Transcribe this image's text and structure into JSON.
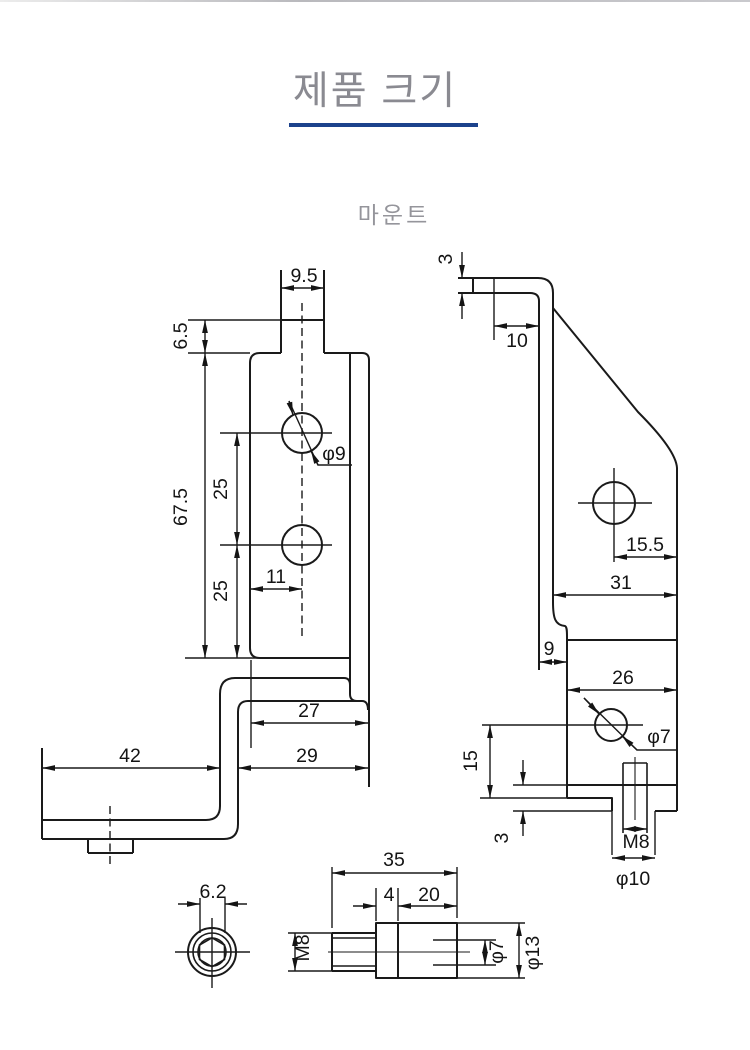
{
  "header": {
    "title": "제품 크기",
    "subtitle": "마운트"
  },
  "colors": {
    "accent": "#1c428c",
    "line": "#1a1a1a",
    "title_gray": "#8a8a91",
    "subtitle_gray": "#95959b"
  },
  "front_view": {
    "dims": {
      "tab_width": "9.5",
      "tab_height": "6.5",
      "total_height": "67.5",
      "hole_pitch_upper": "25",
      "hole_pitch_lower": "25",
      "hole_offset_x": "11",
      "hole_diameter": "φ9",
      "upper_width": "27",
      "lower_width": "29",
      "leg_length": "42"
    }
  },
  "side_view": {
    "dims": {
      "flange_thickness": "3",
      "flange_length": "10",
      "hole_offset": "15.5",
      "upper_depth": "31",
      "foot_width": "9",
      "lower_depth": "26",
      "hole_diameter": "φ7",
      "hole_height": "15",
      "lip_thickness": "3",
      "thread_size": "M8",
      "boss_diameter": "φ10"
    }
  },
  "hex_end_view": {
    "dims": {
      "socket_size": "6.2"
    }
  },
  "pin_view": {
    "dims": {
      "total_length": "35",
      "collar_length": "4",
      "body_length": "20",
      "thread_size": "M8",
      "hole_diameter": "φ7",
      "body_diameter": "φ13"
    }
  }
}
